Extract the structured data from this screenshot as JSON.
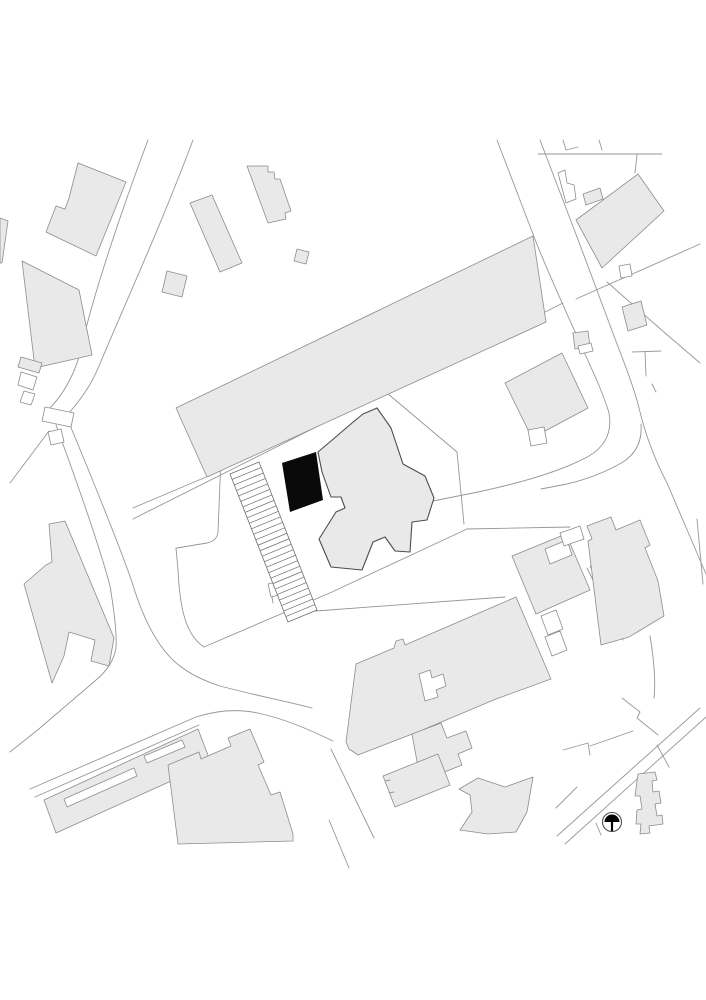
{
  "map": {
    "kind": "architectural-site-plan",
    "palette": {
      "paper": "#ffffff",
      "building_fill": "#e9e9e9",
      "building_stroke": "#8c8c8c",
      "line_color": "#969696",
      "detail_stroke": "#4d4d4d",
      "highlight_fill": "#0a0a0a"
    },
    "features": {
      "highlighted_building": "new-building-footprint",
      "hatched_area": {
        "name": "parking-stall-strip",
        "rung_count": 27
      },
      "north_arrow": {
        "cx": 612,
        "cy": 822,
        "radius": 9.5
      }
    }
  }
}
